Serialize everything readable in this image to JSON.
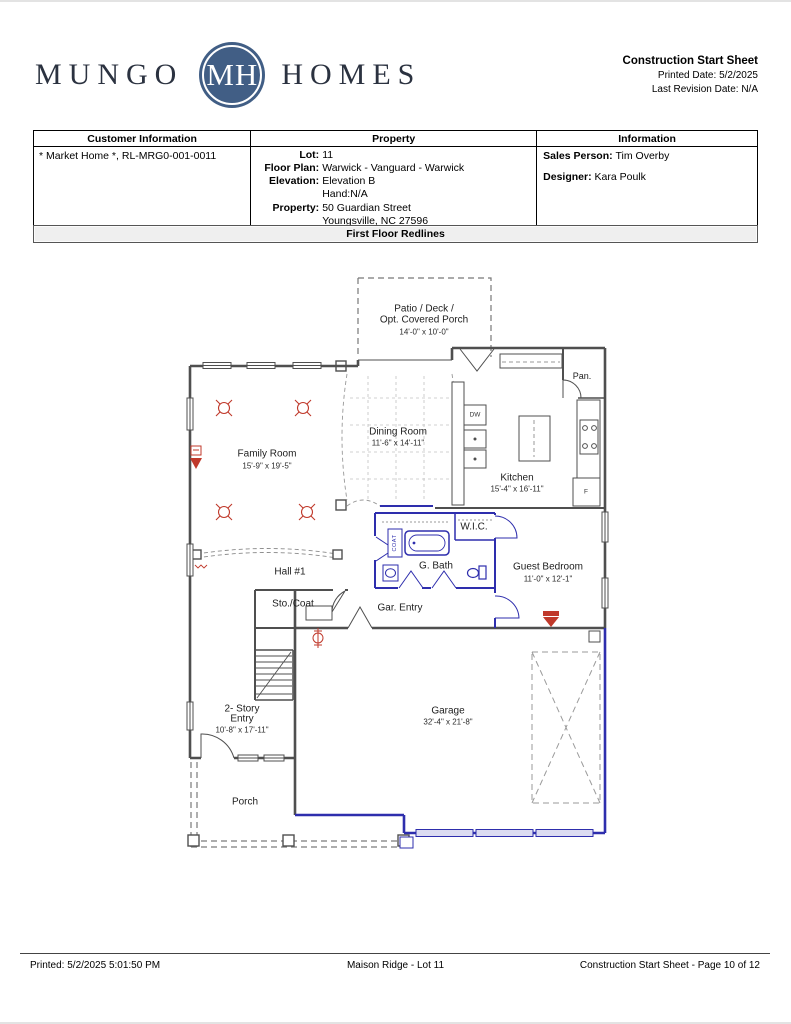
{
  "header": {
    "logo": {
      "word_left": "MUNGO",
      "monogram": "MH",
      "word_right": "HOMES",
      "circle_color": "#415e85"
    },
    "title": "Construction Start Sheet",
    "printed_date_label": "Printed Date: ",
    "printed_date": "5/2/2025",
    "last_revision_label": "Last Revision Date: ",
    "last_revision": "N/A"
  },
  "info_table": {
    "headers": [
      "Customer Information",
      "Property",
      "Information"
    ],
    "customer_value": "* Market Home *, RL-MRG0-001-0011",
    "property": {
      "rows": [
        {
          "label": "Lot:",
          "value": "11"
        },
        {
          "label": "Floor Plan:",
          "value": "Warwick - Vanguard - Warwick"
        },
        {
          "label": "Elevation:",
          "value": "Elevation B"
        },
        {
          "label": "",
          "value": "Hand:N/A"
        },
        {
          "label": "Property:",
          "value": "50 Guardian Street"
        },
        {
          "label": "",
          "value": "Youngsville, NC 27596"
        }
      ]
    },
    "information": {
      "sales_person_label": "Sales Person: ",
      "sales_person": "Tim Overby",
      "designer_label": "Designer: ",
      "designer": "Kara Poulk"
    }
  },
  "section_title": "First Floor Redlines",
  "floor_plan": {
    "labels": {
      "patio_line1": "Patio / Deck /",
      "patio_line2": "Opt. Covered Porch",
      "patio_dims": "14'-0\" x 10'-0\"",
      "dining_name": "Dining Room",
      "dining_dims": "11'-6\" x 14'-11\"",
      "kitchen_name": "Kitchen",
      "kitchen_dims": "15'-4\" x 16'-11\"",
      "family_name": "Family Room",
      "family_dims": "15'-9\" x 19'-5\"",
      "pantry": "Pan.",
      "wic": "W.I.C.",
      "guest_bath": "G. Bath",
      "guest_name": "Guest Bedroom",
      "guest_dims": "11'-0\" x 12'-1\"",
      "hall": "Hall #1",
      "storage_coat": "Sto./Coat",
      "garage_entry": "Gar. Entry",
      "entry_line1": "2- Story",
      "entry_line2": "Entry",
      "entry_dims": "10'-8\" x 17'-11\"",
      "garage_name": "Garage",
      "garage_dims": "32'-4\" x 21'-8\"",
      "porch": "Porch",
      "dishwasher": "DW",
      "fridge": "F",
      "coat_closet": "COAT"
    },
    "colors": {
      "wall_gray": "#4f4f4f",
      "redline_blue": "#2e2ead",
      "marker_red": "#c0392b"
    }
  },
  "footer": {
    "left": "Printed: 5/2/2025 5:01:50 PM",
    "center": "Maison Ridge - Lot 11",
    "right": "Construction Start Sheet - Page 10 of 12"
  }
}
